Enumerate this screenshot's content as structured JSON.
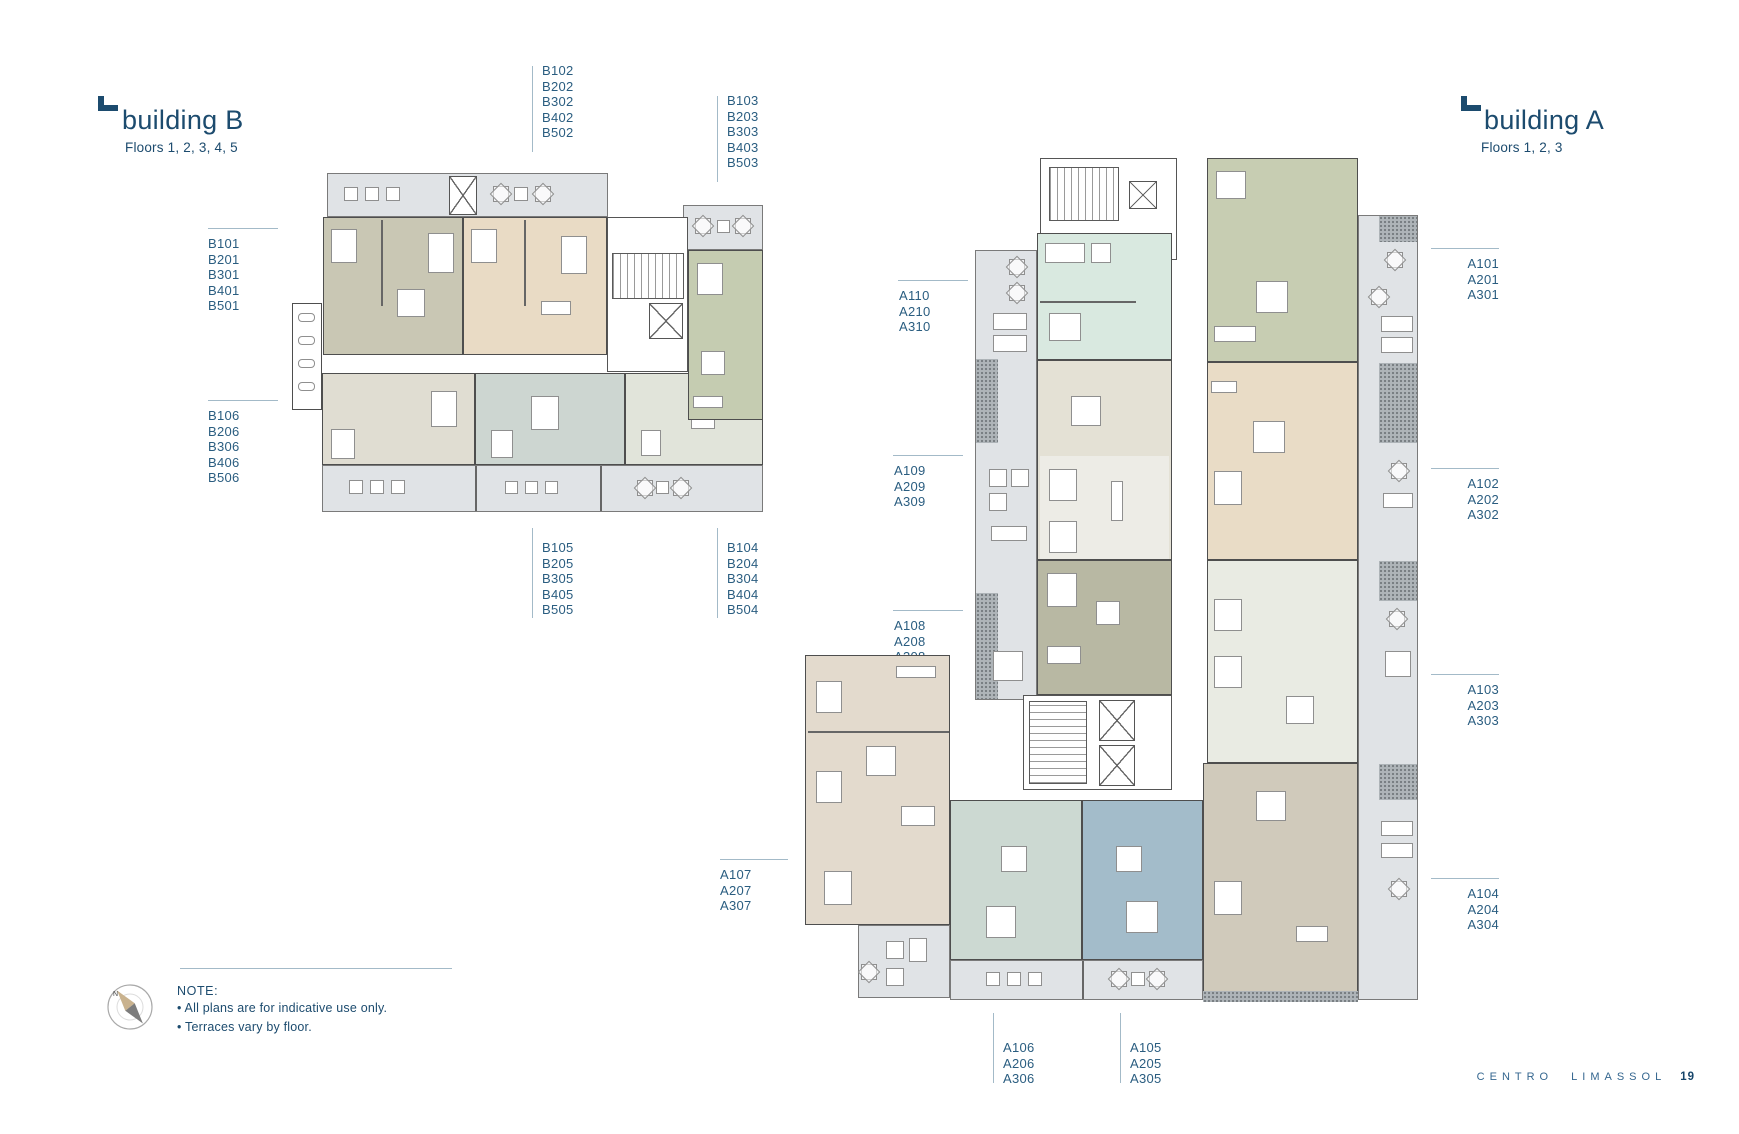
{
  "building_b": {
    "title": "building B",
    "floors": "Floors 1, 2, 3, 4, 5",
    "units": {
      "b101": {
        "stack": [
          "B101",
          "B201",
          "B301",
          "B401",
          "B501"
        ],
        "color": "#c9c7b4"
      },
      "b102": {
        "stack": [
          "B102",
          "B202",
          "B302",
          "B402",
          "B502"
        ],
        "color": "#e9dbc5"
      },
      "b103": {
        "stack": [
          "B103",
          "B203",
          "B303",
          "B403",
          "B503"
        ],
        "color": "#c5ccb1"
      },
      "b104": {
        "stack": [
          "B104",
          "B204",
          "B304",
          "B404",
          "B504"
        ],
        "color": "#e1e4da"
      },
      "b105": {
        "stack": [
          "B105",
          "B205",
          "B305",
          "B405",
          "B505"
        ],
        "color": "#cdd6d1"
      },
      "b106": {
        "stack": [
          "B106",
          "B206",
          "B306",
          "B406",
          "B506"
        ],
        "color": "#e0ddd2"
      }
    }
  },
  "building_a": {
    "title": "building A",
    "floors": "Floors 1, 2, 3",
    "units": {
      "a101": {
        "stack": [
          "A101",
          "A201",
          "A301"
        ],
        "color": "#c7cdb2"
      },
      "a102": {
        "stack": [
          "A102",
          "A202",
          "A302"
        ],
        "color": "#e9dcc6"
      },
      "a103": {
        "stack": [
          "A103",
          "A203",
          "A303"
        ],
        "color": "#e9ebe3"
      },
      "a104": {
        "stack": [
          "A104",
          "A204",
          "A304"
        ],
        "color": "#d0cabb"
      },
      "a105": {
        "stack": [
          "A105",
          "A205",
          "A305"
        ],
        "color": "#a3bcca"
      },
      "a106": {
        "stack": [
          "A106",
          "A206",
          "A306"
        ],
        "color": "#ccd9d2"
      },
      "a107": {
        "stack": [
          "A107",
          "A207",
          "A307"
        ],
        "color": "#e3dacd"
      },
      "a108": {
        "stack": [
          "A108",
          "A208",
          "A308"
        ],
        "color": "#b8b8a3"
      },
      "a109": {
        "stack": [
          "A109",
          "A209",
          "A309"
        ],
        "color": "#e4e1d5"
      },
      "a110": {
        "stack": [
          "A110",
          "A210",
          "A310"
        ],
        "color": "#d9e9e0"
      }
    }
  },
  "note": {
    "heading": "NOTE:",
    "lines": [
      "• All plans are for indicative use only.",
      "• Terraces vary by floor."
    ]
  },
  "compass": {
    "north": "N"
  },
  "footer": {
    "brand": "CENTRO LIMASSOL",
    "page_number": "19"
  },
  "palette": {
    "title_text": "#1c4b6e",
    "label_text": "#2a5d80",
    "rule_line": "#a3bac8",
    "terrace_fill": "#e0e3e6",
    "wall": "#4e4e4e",
    "stipple_fill": "#aeb4b8",
    "footer_text": "#34668f",
    "page_number_text": "#16456a"
  }
}
